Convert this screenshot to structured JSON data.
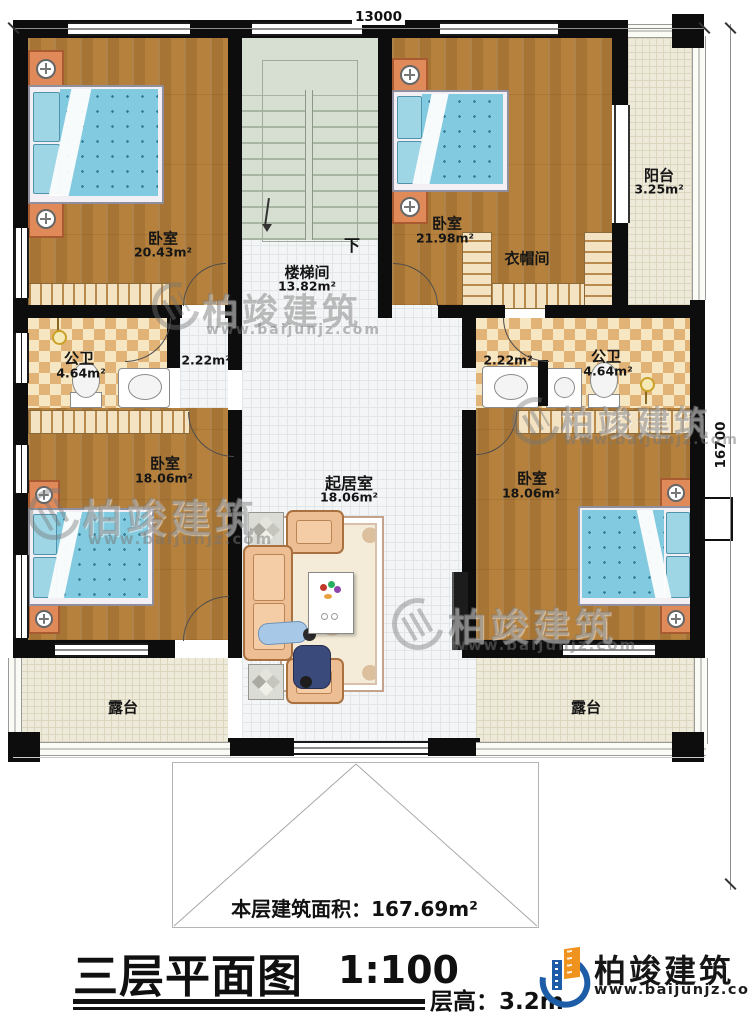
{
  "dimensions": {
    "top": "13000",
    "right": "16700"
  },
  "rooms": {
    "bedroom_tl": {
      "name": "卧室",
      "area": "20.43m²"
    },
    "stairwell": {
      "name": "楼梯间",
      "area": "13.82m²",
      "direction_down": "下"
    },
    "bedroom_tr": {
      "name": "卧室",
      "area": "21.98m²"
    },
    "cloakroom": {
      "name": "衣帽间"
    },
    "balcony": {
      "name": "阳台",
      "area": "3.25m²"
    },
    "bathroom_left": {
      "name": "公卫",
      "area": "4.64m²"
    },
    "hall_left": {
      "area": "2.22m²"
    },
    "hall_right": {
      "area": "2.22m²"
    },
    "bathroom_right": {
      "name": "公卫",
      "area": "4.64m²"
    },
    "bedroom_bl": {
      "name": "卧室",
      "area": "18.06m²"
    },
    "living_room": {
      "name": "起居室",
      "area": "18.06m²"
    },
    "bedroom_br": {
      "name": "卧室",
      "area": "18.06m²"
    },
    "terrace_left": {
      "name": "露台"
    },
    "terrace_right": {
      "name": "露台"
    }
  },
  "notes": {
    "floor_area_label": "本层建筑面积：",
    "floor_area_value": "167.69m²"
  },
  "title_block": {
    "title": "三层平面图",
    "scale": "1:100",
    "floor_height": "层高：3.2m"
  },
  "brand": {
    "name": "柏竣建筑",
    "website": "www.baijunjz.com"
  },
  "colors": {
    "wall": "#0d0d0d",
    "wood_floor": "#b5813c",
    "bath_tile": "#e2b377",
    "mattress": "#82cadf",
    "logo_blue": "#1d5ca7",
    "logo_orange": "#f0921e"
  }
}
